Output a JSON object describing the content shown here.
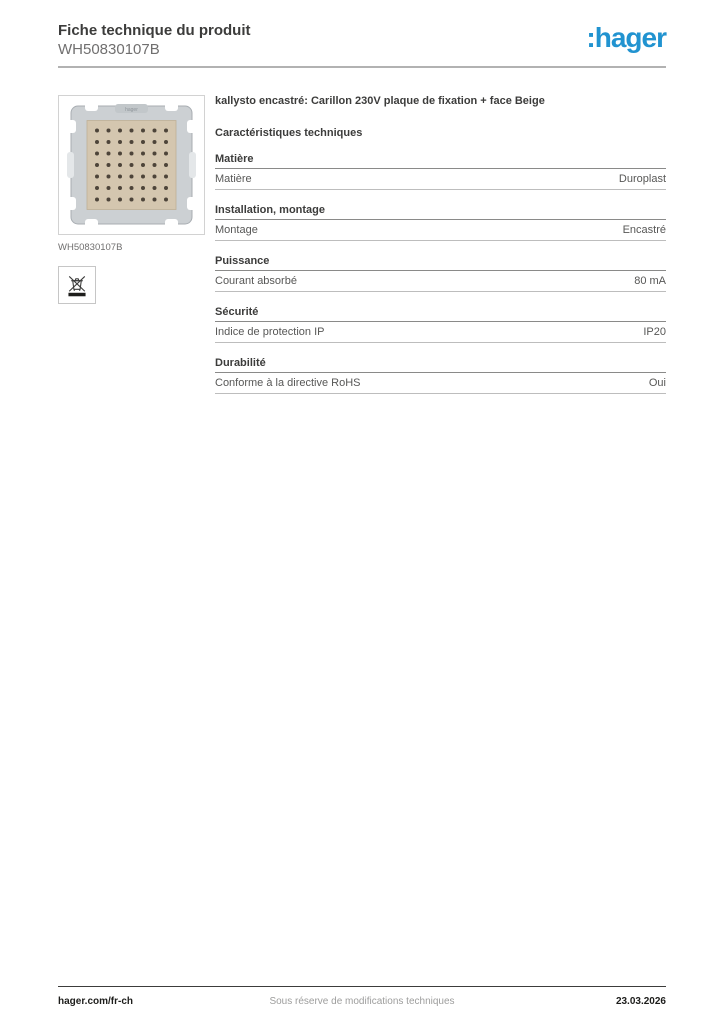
{
  "header": {
    "title": "Fiche technique du produit",
    "reference": "WH50830107B",
    "logo_text": ":hager",
    "logo_color": "#2193d0"
  },
  "product": {
    "title": "kallysto encastré: Carillon 230V plaque de fixation + face Beige",
    "image_caption": "WH50830107B",
    "image_icons": [
      "weee-crossed-out-bin-icon"
    ],
    "image_colors": {
      "plate_beige": "#d4c6af",
      "frame_gray": "#ccd0d3",
      "dot_brown": "#4d443a"
    }
  },
  "characteristics": {
    "heading": "Caractéristiques techniques",
    "sections": [
      {
        "title": "Matière",
        "rows": [
          {
            "label": "Matière",
            "value": "Duroplast"
          }
        ]
      },
      {
        "title": "Installation, montage",
        "rows": [
          {
            "label": "Montage",
            "value": "Encastré"
          }
        ]
      },
      {
        "title": "Puissance",
        "rows": [
          {
            "label": "Courant absorbé",
            "value": "80 mA"
          }
        ]
      },
      {
        "title": "Sécurité",
        "rows": [
          {
            "label": "Indice de protection IP",
            "value": "IP20"
          }
        ]
      },
      {
        "title": "Durabilité",
        "rows": [
          {
            "label": "Conforme à la directive RoHS",
            "value": "Oui"
          }
        ]
      }
    ]
  },
  "footer": {
    "website": "hager.com/fr-ch",
    "disclaimer": "Sous réserve de modifications techniques",
    "date": "23.03.2026"
  }
}
